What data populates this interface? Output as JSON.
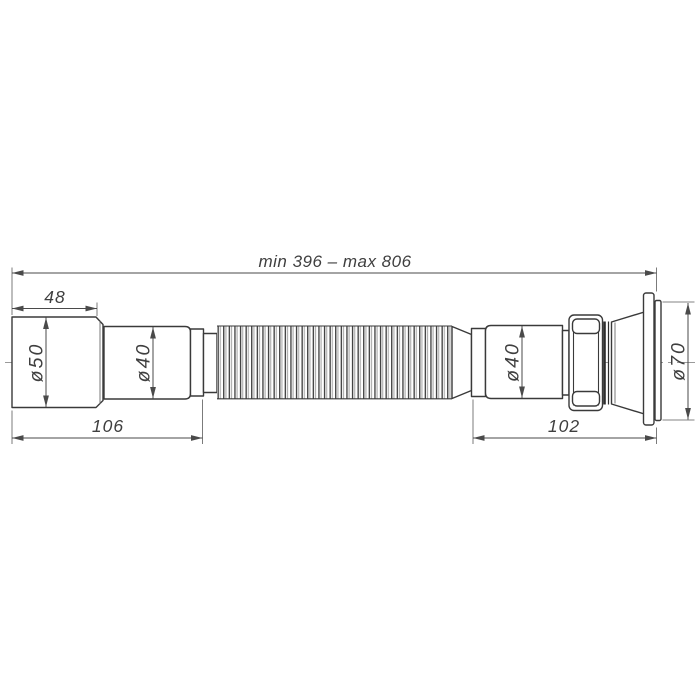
{
  "meta": {
    "type": "technical-drawing",
    "subject": "flexible corrugated sink waste pipe (gofra siphon)",
    "background": "#ffffff"
  },
  "colors": {
    "outline": "#3a3a3a",
    "dimension_lines": "#4a4a4a",
    "text": "#3f3f3f",
    "centerline": "#9a9a9a",
    "corrugation_shadow": "#b0b0b0"
  },
  "dimensions": {
    "overall_length": "min 396 – max 806",
    "inlet_cup_length": "48",
    "inlet_diameter": "ø50",
    "left_pipe_diameter": "ø40",
    "left_assembly_length": "106",
    "right_pipe_diameter": "ø40",
    "right_assembly_length": "102",
    "outlet_flange_diameter": "ø70"
  }
}
